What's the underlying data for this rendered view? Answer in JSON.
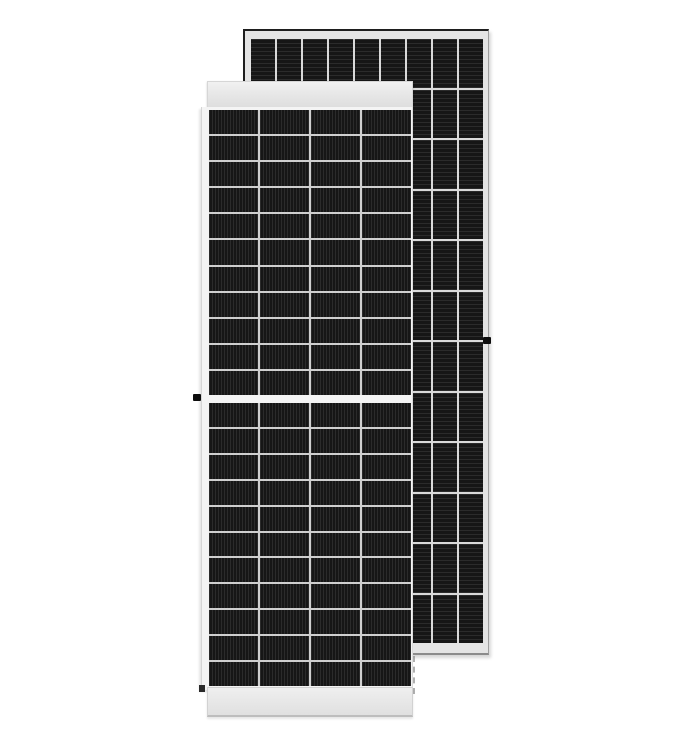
{
  "scene": {
    "type": "product-photo",
    "subject": "Two framed monocrystalline solar panels standing on a white background; a portrait front panel with half-cut cells and a center split overlaps a second panel behind it, offset up and to the right",
    "background_color": "#ffffff"
  },
  "front_panel": {
    "description": "Front solar panel, portrait, white aluminum frame, top and bottom rails, center split between upper and lower cell halves, black grounding stud on left frame at mid-height",
    "cell_stripe_direction": "vertical",
    "top_half_grid": {
      "rows": 11,
      "cols": 4,
      "stripes": "v"
    },
    "bottom_half_grid": {
      "rows": 11,
      "cols": 4,
      "stripes": "v"
    },
    "grounding_lug": "black stud, left frame, mid-height",
    "corner_mark": "dark notch at lower-left frame corner"
  },
  "back_panel": {
    "description": "Second solar panel behind, portrait, light gray frame with dark outline, dense cell grid with horizontal stripe texture, black grounding stud on right frame at mid-height",
    "cell_stripe_direction": "horizontal",
    "grid": {
      "rows": 12,
      "cols": 9,
      "stripes": "h"
    },
    "grounding_lug": "black stud, right frame, mid-height"
  },
  "shadow": {
    "description": "short dashed vertical shadow edge below the rear panel, right of the front panel"
  },
  "colors": {
    "background": "#ffffff",
    "panel_frame_light": "#e4e4e4",
    "panel_frame_white": "#f4f4f4",
    "cell_black": "#161616",
    "cell_stripe_light": "#2b2b2b",
    "grid_line_front": "#cfcfcf",
    "grid_line_back": "#d9d9d9",
    "frame_border_dark": "#1e1e1e"
  }
}
